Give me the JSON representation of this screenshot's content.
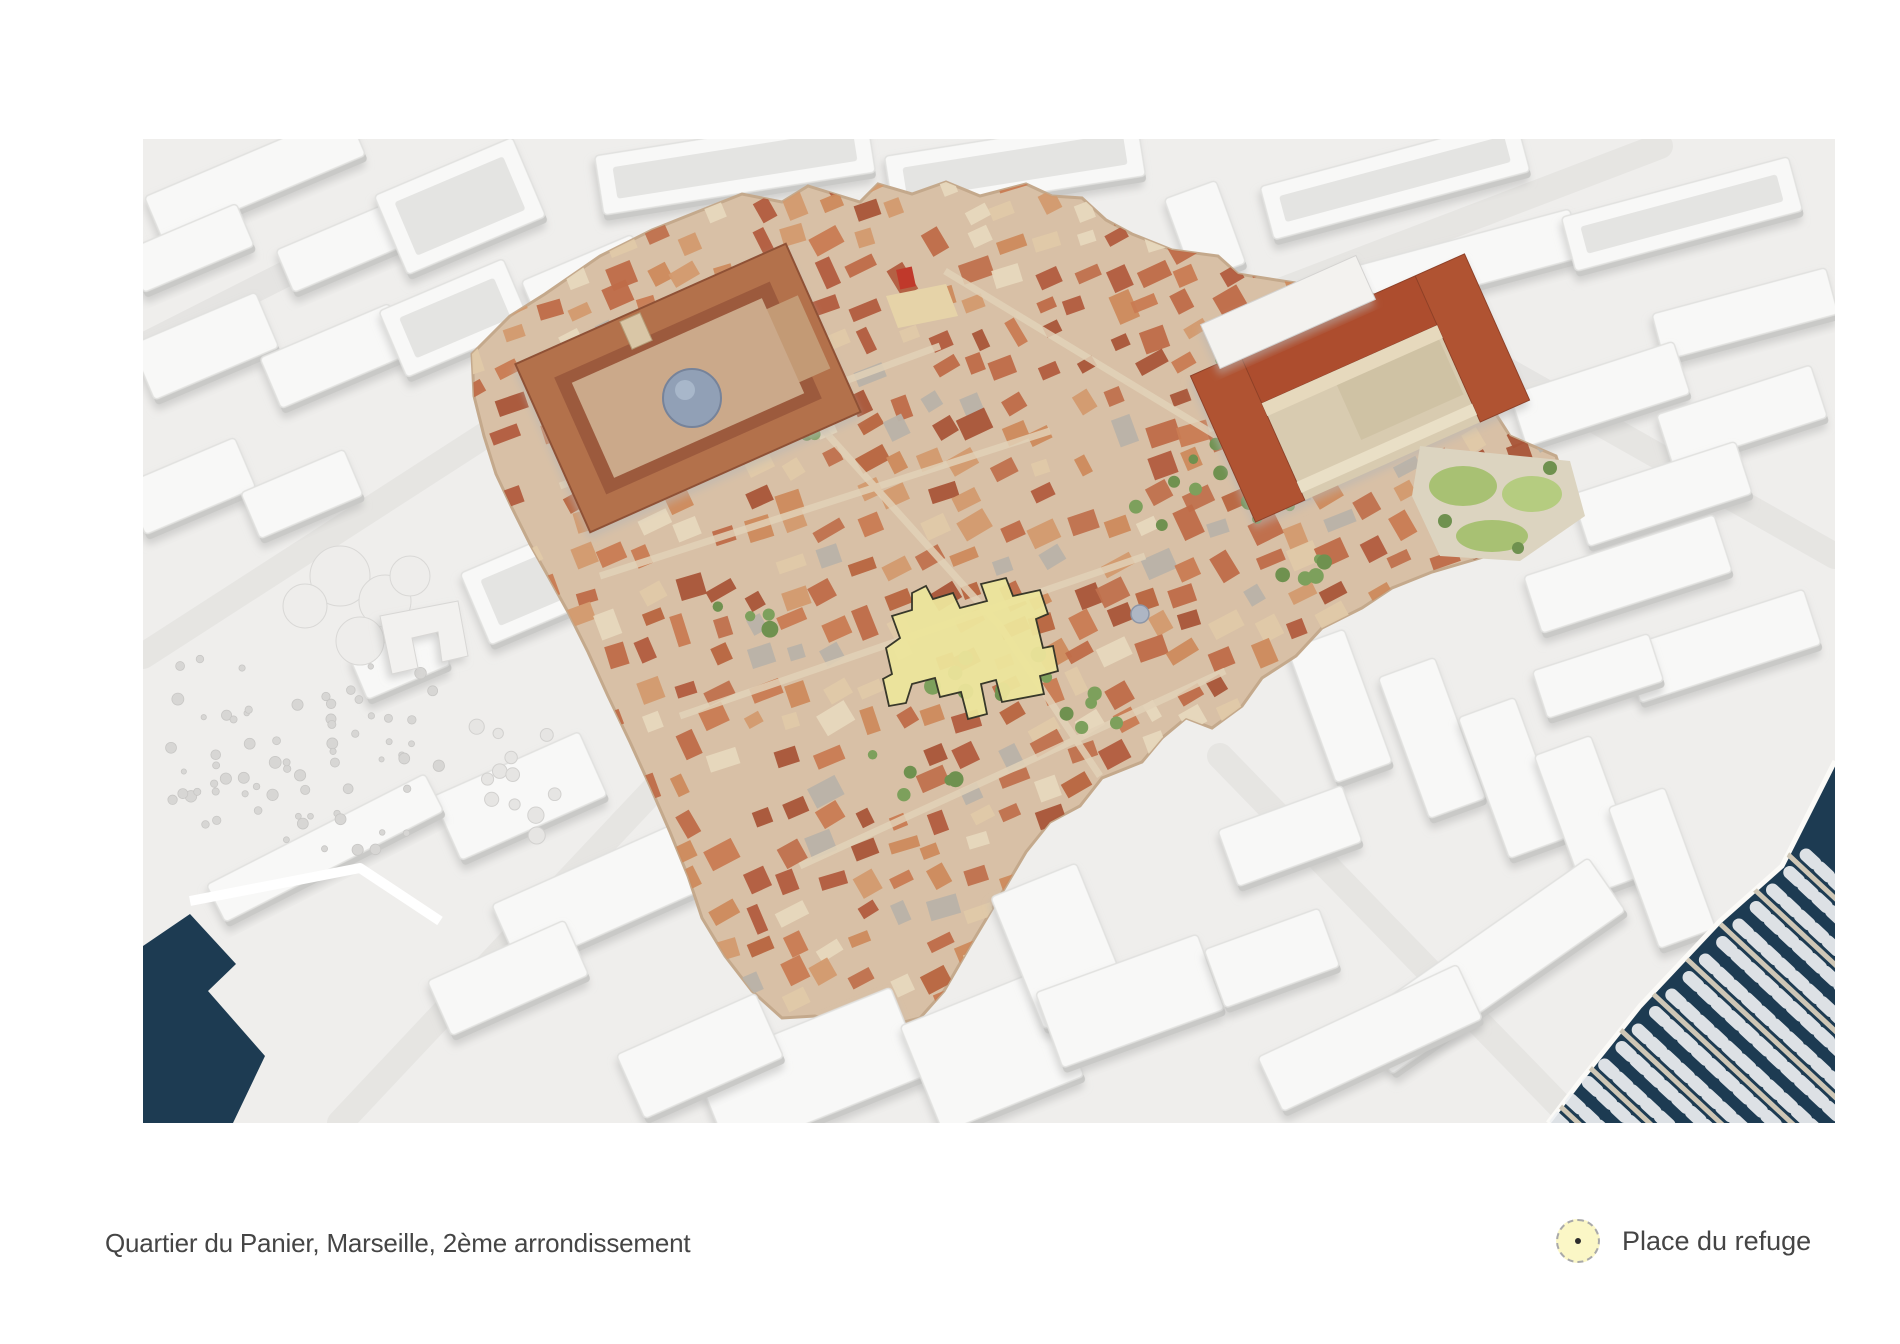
{
  "caption": {
    "text": "Quartier du Panier, Marseille, 2ème arrondissement"
  },
  "legend": {
    "items": [
      {
        "label": "Place du refuge",
        "marker": "dashed-circle",
        "marker_fill": "#fbf7c6"
      }
    ]
  },
  "figure": {
    "highlighted_place": "Place du refuge",
    "district": "Quartier du Panier",
    "city": "Marseille",
    "arrondissement": "2ème arrondissement"
  },
  "colors": {
    "page_bg": "#ffffff",
    "ground": "#efeeec",
    "street": "#e4e3e1",
    "clay_top": "#f8f8f7",
    "clay_wall": "#c9c9c7",
    "clay_court": "#e4e4e2",
    "district_ground": "#d8c0a6",
    "district_street": "#e2d2b8",
    "roof_primary": "#bf6b48",
    "lawn": "#a8c173",
    "tree": "#6f914f",
    "water": "#1d3b52",
    "pier": "#cfc7b6",
    "boat": "#eef0f2",
    "highlight_fill": "#ece59b",
    "highlight_stroke": "#38382a",
    "legend_swatch_fill": "#fbf7c6",
    "legend_swatch_border": "#a9a9a9",
    "text": "#454545"
  }
}
